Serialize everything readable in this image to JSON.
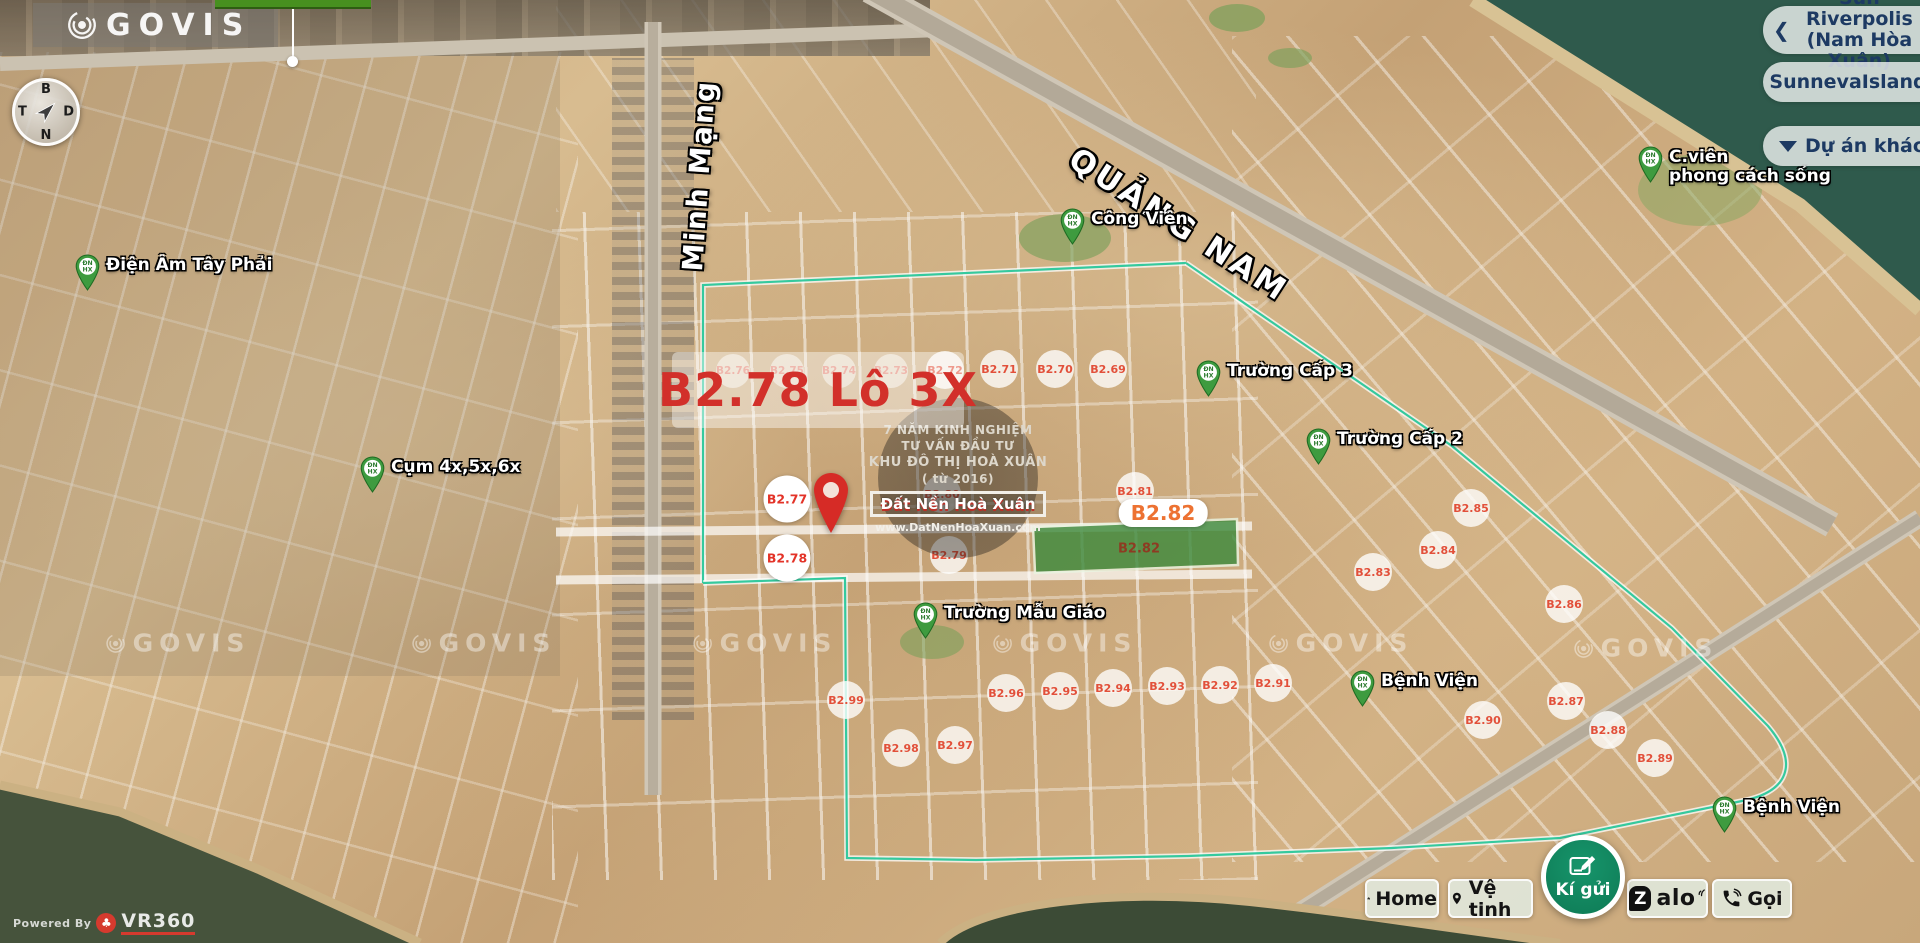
{
  "brand": {
    "name": "GOVIS"
  },
  "compass": {
    "north": "B",
    "south": "N",
    "west": "T",
    "east": "D"
  },
  "right_panel": {
    "back_chevron": "❮",
    "project_current_line1": "Sun Riverpolis",
    "project_current_line2": "(Nam Hòa Xuân)",
    "project_alt": "SunnevaIsland",
    "more_label": "Dự án khác"
  },
  "map": {
    "title": "B2.78 Lô 3X",
    "roads": {
      "main": "QUẢNG NAM",
      "vertical": "Minh Mạng"
    },
    "pin_text": [
      "ĐN",
      "HX"
    ],
    "info_circle": {
      "line1": "7 NĂM KINH NGHIỆM",
      "line2": "TƯ VẤN ĐẦU TƯ",
      "line3": "KHU ĐÔ THỊ HOÀ XUÂN",
      "line4": "( từ 2016)",
      "brand_box": "Đất Nền Hoà Xuân",
      "website": "www.DatNenHoaXuan.com"
    },
    "highlight": {
      "box_label": "B2.82",
      "green_lot_label": "B2.82"
    },
    "lot_badges": [
      {
        "label": "B2.76",
        "x": 733,
        "y": 371,
        "style": "faint"
      },
      {
        "label": "B2.75",
        "x": 787,
        "y": 371,
        "style": "faint"
      },
      {
        "label": "B2.74",
        "x": 839,
        "y": 371,
        "style": "faint"
      },
      {
        "label": "B2.73",
        "x": 891,
        "y": 371,
        "style": "faint"
      },
      {
        "label": "B2.72",
        "x": 945,
        "y": 370,
        "style": "normal"
      },
      {
        "label": "B2.71",
        "x": 999,
        "y": 369,
        "style": "normal"
      },
      {
        "label": "B2.70",
        "x": 1055,
        "y": 369,
        "style": "normal"
      },
      {
        "label": "B2.69",
        "x": 1108,
        "y": 369,
        "style": "normal"
      },
      {
        "label": "B2.77",
        "x": 787,
        "y": 499,
        "style": "featured"
      },
      {
        "label": "B2.78",
        "x": 787,
        "y": 558,
        "style": "featured"
      },
      {
        "label": "B2.80",
        "x": 942,
        "y": 494,
        "style": "normal"
      },
      {
        "label": "B2.79",
        "x": 949,
        "y": 555,
        "style": "normal"
      },
      {
        "label": "B2.81",
        "x": 1135,
        "y": 491,
        "style": "normal"
      },
      {
        "label": "B2.83",
        "x": 1373,
        "y": 572,
        "style": "normal"
      },
      {
        "label": "B2.84",
        "x": 1438,
        "y": 550,
        "style": "normal"
      },
      {
        "label": "B2.85",
        "x": 1471,
        "y": 508,
        "style": "normal"
      },
      {
        "label": "B2.86",
        "x": 1564,
        "y": 604,
        "style": "normal"
      },
      {
        "label": "B2.87",
        "x": 1566,
        "y": 701,
        "style": "normal"
      },
      {
        "label": "B2.88",
        "x": 1608,
        "y": 730,
        "style": "normal"
      },
      {
        "label": "B2.89",
        "x": 1655,
        "y": 758,
        "style": "normal"
      },
      {
        "label": "B2.90",
        "x": 1483,
        "y": 720,
        "style": "normal"
      },
      {
        "label": "B2.91",
        "x": 1273,
        "y": 683,
        "style": "normal"
      },
      {
        "label": "B2.92",
        "x": 1220,
        "y": 685,
        "style": "normal"
      },
      {
        "label": "B2.93",
        "x": 1167,
        "y": 686,
        "style": "normal"
      },
      {
        "label": "B2.94",
        "x": 1113,
        "y": 688,
        "style": "normal"
      },
      {
        "label": "B2.95",
        "x": 1060,
        "y": 691,
        "style": "normal"
      },
      {
        "label": "B2.96",
        "x": 1006,
        "y": 693,
        "style": "normal"
      },
      {
        "label": "B2.97",
        "x": 955,
        "y": 745,
        "style": "normal"
      },
      {
        "label": "B2.98",
        "x": 901,
        "y": 748,
        "style": "normal"
      },
      {
        "label": "B2.99",
        "x": 846,
        "y": 700,
        "style": "normal"
      }
    ],
    "pois": [
      {
        "label": "Điện Âm Tây Phải",
        "x": 87,
        "y": 266
      },
      {
        "label": "Cụm 4x,5x,6x",
        "x": 372,
        "y": 468
      },
      {
        "label": "Công Viên",
        "x": 1072,
        "y": 220
      },
      {
        "label": "Trường Cấp 3",
        "x": 1208,
        "y": 372
      },
      {
        "label": "Trường Cấp 2",
        "x": 1318,
        "y": 440
      },
      {
        "label": "Trường Mẫu Giáo",
        "x": 925,
        "y": 614
      },
      {
        "label": "Bệnh Viện",
        "x": 1362,
        "y": 682
      },
      {
        "label": "Bệnh Viện",
        "x": 1724,
        "y": 808
      },
      {
        "label": "C.viên",
        "label2": "phong cách sống",
        "x": 1650,
        "y": 158
      }
    ],
    "watermarks": [
      {
        "text": "GOVIS",
        "x": 178,
        "y": 643
      },
      {
        "text": "GOVIS",
        "x": 484,
        "y": 643
      },
      {
        "text": "GOVIS",
        "x": 765,
        "y": 643
      },
      {
        "text": "GOVIS",
        "x": 1065,
        "y": 643
      },
      {
        "text": "GOVIS",
        "x": 1341,
        "y": 643
      },
      {
        "text": "GOVIS",
        "x": 1646,
        "y": 648
      }
    ]
  },
  "toolbar": {
    "home": "Home",
    "satellite": "Vệ tinh",
    "submit": "Kí gửi",
    "zalo_z": "Z",
    "zalo_rest": "alo",
    "call": "Gọi"
  },
  "footer": {
    "powered_by": "Powered By",
    "brand": "VR360"
  }
}
